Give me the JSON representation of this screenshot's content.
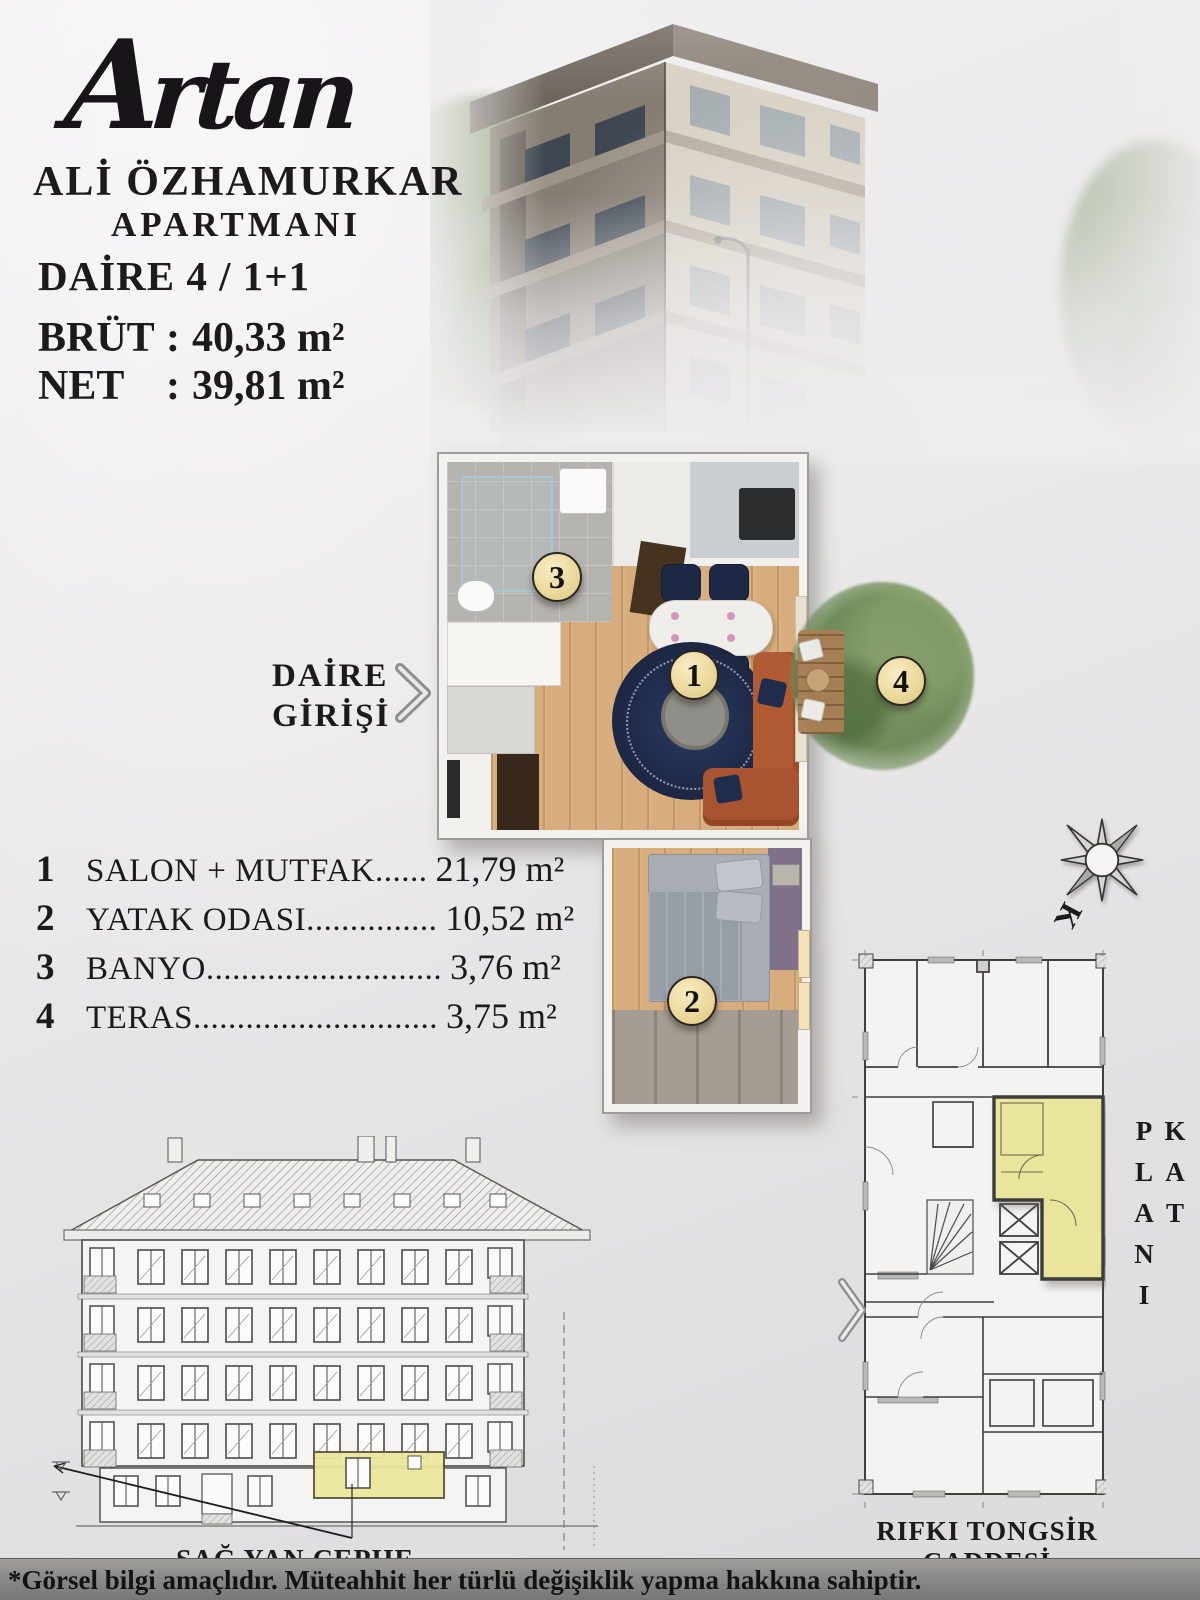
{
  "header": {
    "logo_text": "Artan",
    "building_name_line1": "ALİ ÖZHAMURKAR",
    "building_name_line2": "APARTMANI",
    "unit_title": "DAİRE 4 / 1+1",
    "gross": {
      "label": "BRÜT",
      "colon": ":",
      "value": "40,33 m²"
    },
    "net": {
      "label": "NET",
      "colon": ":",
      "value": "39,81 m²"
    }
  },
  "entrance_label": {
    "line1": "DAİRE",
    "line2": "GİRİŞİ"
  },
  "rooms": [
    {
      "num": "1",
      "name": "SALON + MUTFAK",
      "dots": "......",
      "area": "21,79 m²"
    },
    {
      "num": "2",
      "name": "YATAK ODASI",
      "dots": "...............",
      "area": "10,52 m²"
    },
    {
      "num": "3",
      "name": "BANYO",
      "dots": "...........................",
      "area": "3,76 m²"
    },
    {
      "num": "4",
      "name": "TERAS",
      "dots": "............................",
      "area": "3,75 m²"
    }
  ],
  "plan_badges": {
    "salon": "1",
    "bedroom": "2",
    "bathroom": "3",
    "terrace": "4"
  },
  "compass": {
    "north_letter": "K"
  },
  "elevation": {
    "caption": "SAĞ YAN CEPHE"
  },
  "site_plan": {
    "side_label": "KAT PLANI",
    "street_label": "RIFKI TONGSİR CADDESİ"
  },
  "footer": {
    "disclaimer": "*Görsel bilgi amaçlıdır. Müteahhit her türlü değişiklik yapma hakkına sahiptir."
  },
  "colors": {
    "highlight_yellow": "#ebe69c",
    "badge_cream": "#ecd99e",
    "terrace_green": "#6f8c5a",
    "footer_gray": "#8e8b8b",
    "text_dark": "#1d1a1b"
  }
}
